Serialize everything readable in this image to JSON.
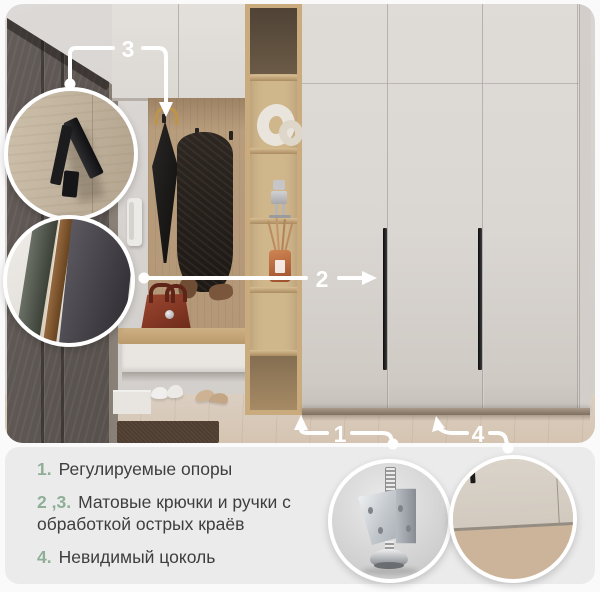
{
  "callouts": {
    "c1": "1",
    "c2": "2",
    "c3": "3",
    "c4": "4"
  },
  "features": {
    "items": [
      {
        "num": "1.",
        "text": "Регулируемые опоры"
      },
      {
        "num": "2 ,3.",
        "text": "Матовые крючки и ручки с обработкой острых краёв"
      },
      {
        "num": "4.",
        "text": "Невидимый цоколь"
      }
    ]
  },
  "insets": {
    "top": [
      "hook-closeup",
      "handle-edge-closeup"
    ],
    "bottom": [
      "adjustable-foot-closeup",
      "invisible-plinth-closeup"
    ]
  },
  "colors": {
    "accent_green": "#8fae97",
    "text": "#3f3e3e",
    "panel_bg": "#ebebeb",
    "callout_white": "#ffffff",
    "wardrobe_door": "#dad6d2",
    "oak_wood": "#b89d7d"
  }
}
